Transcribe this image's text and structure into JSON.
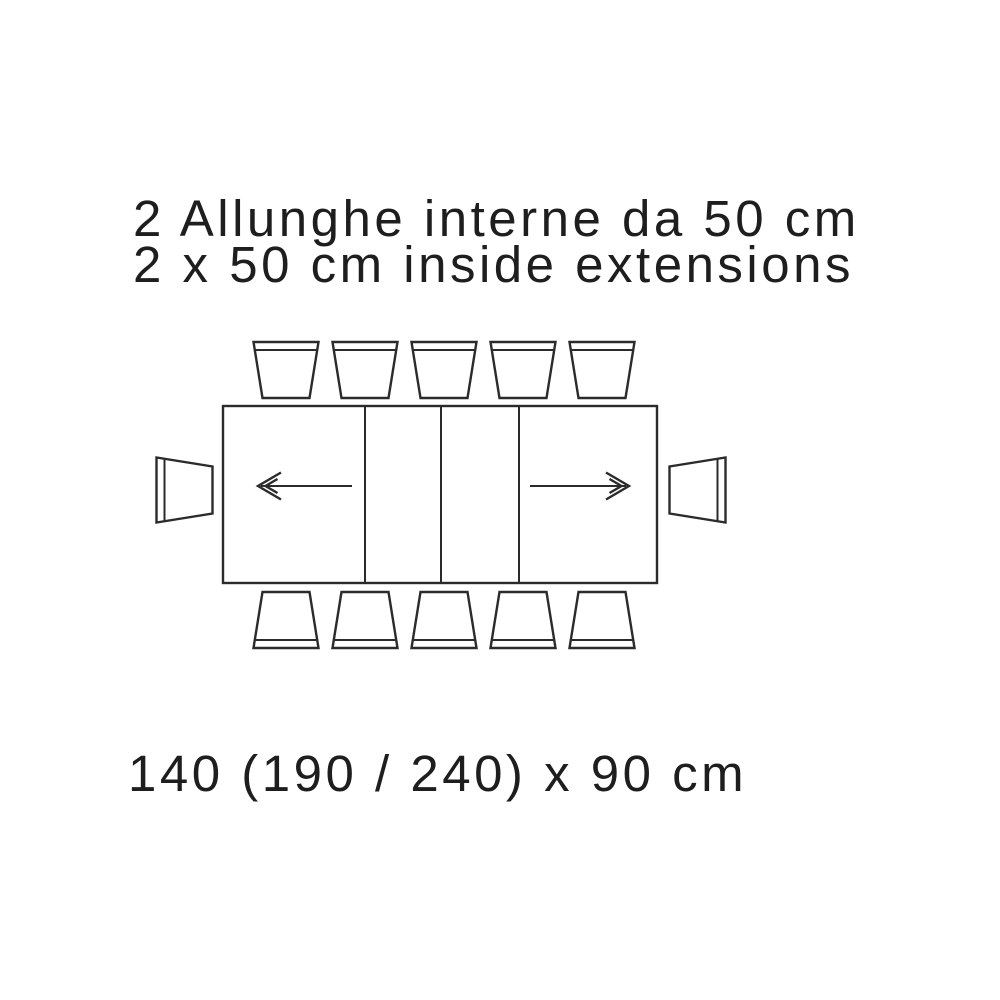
{
  "header": {
    "line1": "2 Allunghe interne da 50 cm",
    "line2": "2 x 50 cm inside extensions"
  },
  "footer": {
    "dimensions": "140 (190 / 240) x 90 cm"
  },
  "diagram": {
    "type": "table-extension-plan-top-view",
    "table_sections": 4,
    "inside_extensions": 2,
    "chairs": {
      "top": 5,
      "bottom": 5,
      "left": 1,
      "right": 1,
      "total": 12
    },
    "extension_arrows": [
      "left",
      "right"
    ],
    "colors": {
      "line": "#2b2b2b",
      "text": "#1e1e1e",
      "background": "#ffffff"
    }
  }
}
